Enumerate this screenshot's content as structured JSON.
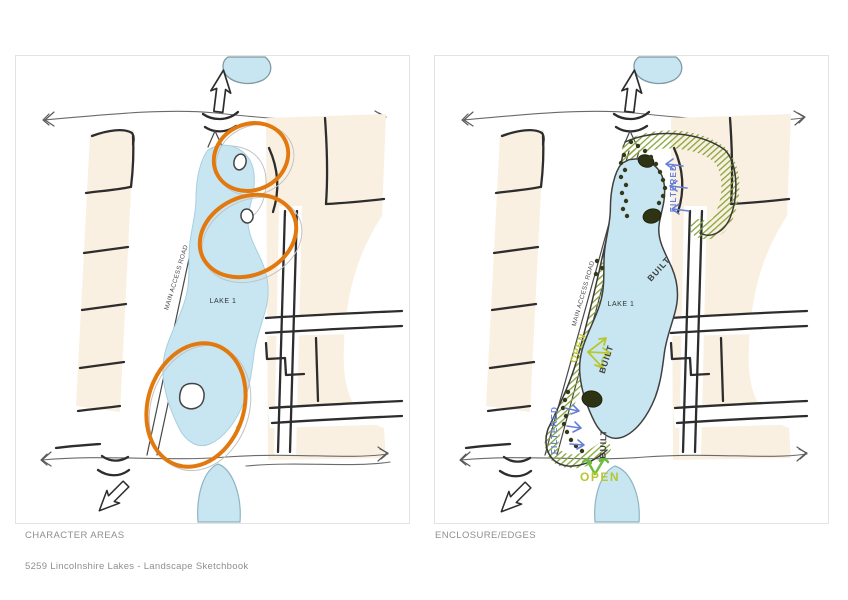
{
  "document": {
    "footer_text": "5259 Lincolnshire Lakes - Landscape Sketchbook"
  },
  "panels": [
    {
      "caption": "CHARACTER AREAS",
      "labels": {
        "road": "MAIN ACCESS ROAD",
        "lake": "LAKE 1"
      }
    },
    {
      "caption": "ENCLOSURE/EDGES",
      "labels": {
        "road": "MAIN ACCESS ROAD",
        "lake": "LAKE 1",
        "filtered": "FILTERED",
        "built": "BUILT",
        "open": "OPEN"
      }
    }
  ],
  "colors": {
    "water": "#c7e6f2",
    "building_parcel": "#faf0e2",
    "sketch_ink": "#2d2d2d",
    "character_area_outline": "#e2790f",
    "vegetation_hatch": "#86a438",
    "filtered_edge_label": "#667fd9",
    "built_edge_label": "#3d3d3d",
    "open_edge_label": "#b8c72f",
    "open_arrow_green": "#6cbc3e",
    "caption_text": "#8f8f8f"
  }
}
